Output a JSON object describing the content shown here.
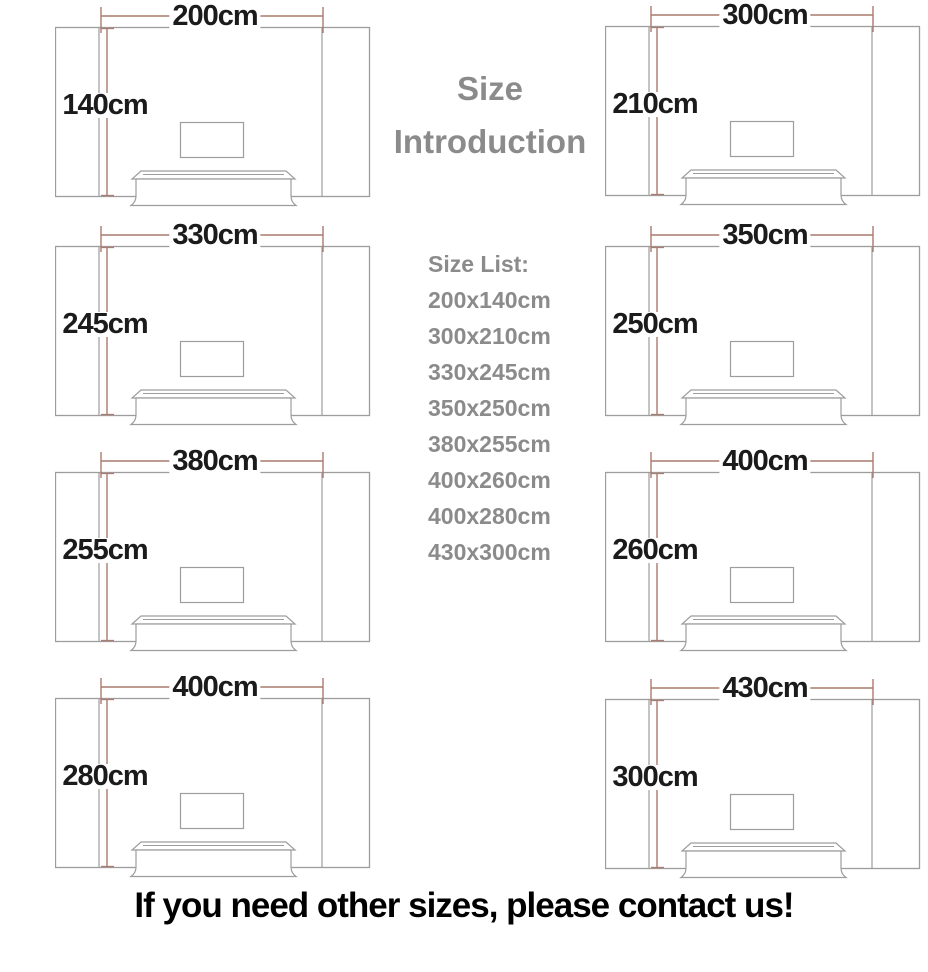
{
  "title": {
    "line1": "Size",
    "line2": "Introduction"
  },
  "size_list": {
    "heading": "Size List:",
    "items": [
      "200x140cm",
      "300x210cm",
      "330x245cm",
      "350x250cm",
      "380x255cm",
      "400x260cm",
      "400x280cm",
      "430x300cm"
    ]
  },
  "footer": "If you need other sizes, please contact us!",
  "colors": {
    "dimension_line": "#aa7b6f",
    "wall_line": "#9d9d9d",
    "label_text": "#1b1b1b",
    "gray_text": "#8b8b8b"
  },
  "diagrams": [
    {
      "width_label": "200cm",
      "height_label": "140cm"
    },
    {
      "width_label": "300cm",
      "height_label": "210cm"
    },
    {
      "width_label": "330cm",
      "height_label": "245cm"
    },
    {
      "width_label": "350cm",
      "height_label": "250cm"
    },
    {
      "width_label": "380cm",
      "height_label": "255cm"
    },
    {
      "width_label": "400cm",
      "height_label": "260cm"
    },
    {
      "width_label": "400cm",
      "height_label": "280cm"
    },
    {
      "width_label": "430cm",
      "height_label": "300cm"
    }
  ]
}
